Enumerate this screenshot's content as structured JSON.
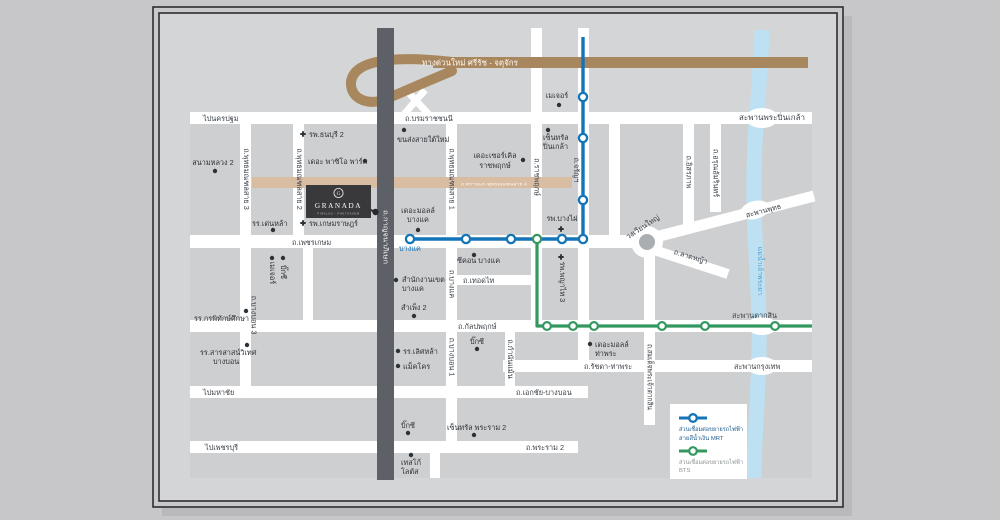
{
  "map": {
    "expressway": {
      "label": "ทางด่วนใหม่ ศรีรัช - จตุจักร",
      "color": "#a8875f"
    },
    "roads": {
      "pai_nakhonpathom": "ไปนครปฐม",
      "borommaratchachonnani": "ถ.บรมราชชนนี",
      "phetkasem": "ถ.เพชรเกษม",
      "kalpapruek": "ถ.กัลปพฤกษ์",
      "thoet_thai": "ถ.เทอดไท",
      "pai_mahachai": "ไปมหาชัย",
      "ekkachai_bangbon": "ถ.เอกชัย-บางบอน",
      "pai_phetchaburi": "ไปเพชรบุรี",
      "rama2": "ถ.พระราม 2",
      "ratchada_thapra": "ถ.รัชดา-ท่าพระ",
      "lat_ya": "ถ.ลาดหญ้า",
      "wongwian_yai": "วงเวียนใหญ่",
      "prannok_sai4": "ถ.พรานนก-พุทธมณฑลสาย 4",
      "phutthamonthon_sai3": "ถ.พุทธมณฑลสาย 3",
      "phutthamonthon_sai2": "ถ.พุทธมณฑลสาย 2",
      "phutthamonthon_sai1": "ถ.พุทธมณฑลสาย 1",
      "ratchapruek": "ถ.ราชพฤกษ์",
      "charan": "ถ.จรัญฯ",
      "itsaraphap": "ถ.อิสรภาพ",
      "arun_amarin": "ถ.อรุณอัมรินทร์",
      "kanchanaphisek": "ถ.กาญจนาภิเษก",
      "bangbon3": "ถ.บางบอน 3",
      "bangkhae_rd": "ถ.บางแค",
      "bangbon1": "ถ.บางบอน 1",
      "kamnan_maen": "ถ.กำนันแม้น",
      "somdet_taksin": "ถ.สมเด็จพระเจ้าตากสิน"
    },
    "bridges": {
      "saphan_phra_pinklao": "สะพานพระปิ่นเกล้า",
      "saphan_phut": "สะพานพุทธ",
      "saphan_taksin": "สะพานตากสิน",
      "saphan_krungthep": "สะพานกรุงเทพ"
    },
    "river": {
      "label": "แม่น้ำเจ้าพระยา",
      "color": "#bde1f2"
    },
    "pois": {
      "sanam_luang2": "สนามหลวง 2",
      "thonburi2": "รพ.ธนบุรี 2",
      "paseo_park": "เดอะ พาซิโอ พาร์ค",
      "denla": "รร.เด่นหล้า",
      "kasemrad": "รพ.เกษมราษฎร์",
      "bus_terminal": "ขนส่งสายใต้ใหม่",
      "circle_ratchapruek_1": "เดอะเซอร์เคิล",
      "circle_ratchapruek_2": "ราชพฤกษ์",
      "major_pinklao": "เมเจอร์",
      "central_pinklao_1": "เซ็นทรัล",
      "central_pinklao_2": "ปิ่นเกล้า",
      "bangphai": "รพ.บางไผ่",
      "mall_bangkhae_1": "เดอะมอลล์",
      "mall_bangkhae_2": "บางแค",
      "seacon": "ซีคอน บางแค",
      "district_office_1": "สำนักงานเขต",
      "district_office_2": "บางแค",
      "sampheng2": "สำเพ็ง 2",
      "lertlah": "รร.เลิศหล้า",
      "makro": "แม็คโคร",
      "bigc_kalpapruek": "บิ๊กซี",
      "mall_thapra_1": "เดอะมอลล์",
      "mall_thapra_2": "ท่าพระ",
      "kornpitak": "รร.กรพิทักษ์ศึกษา",
      "sarasas_1": "รร.สารสาสน์วิเทศ",
      "sarasas_2": "บางบอน",
      "bigc_rama2": "บิ๊กซี",
      "central_rama2": "เซ็นทรัล พระราม 2",
      "tesco_1": "เทสโก้",
      "tesco_2": "โลตัส",
      "major_phetkasem": "เมเจอร์",
      "bigc_phetkasem": "บิ๊กซี",
      "phyathai3": "รพ.พญาไท 3"
    },
    "transit": {
      "mrt_color": "#1474b8",
      "bts_color": "#33985f",
      "station_bangkhae": "บางแค"
    },
    "granada": {
      "monogram": "G",
      "name": "GRANADA",
      "tagline": "PINKLAO - PHETKASEM"
    },
    "legend": {
      "mrt_line1": "ส่วนเชื่อมต่อขยายรถไฟฟ้า",
      "mrt_line2": "สายสีน้ำเงิน MRT",
      "bts_line1": "ส่วนเชื่อมต่อขยายรถไฟฟ้า",
      "bts_line2": "BTS"
    }
  }
}
